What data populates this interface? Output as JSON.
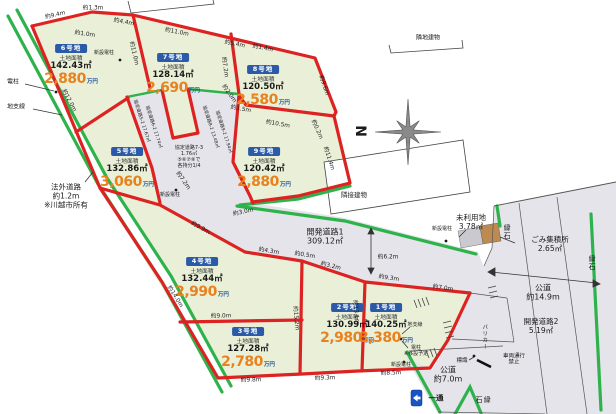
{
  "plots": [
    {
      "id": "6号地",
      "area_label": "土地面積",
      "area": "142.43㎡",
      "price": "2,880",
      "unit": "万円",
      "x": 71,
      "y": 37
    },
    {
      "id": "7号地",
      "area_label": "土地面積",
      "area": "128.14㎡",
      "price": "2,690",
      "unit": "万円",
      "x": 173,
      "y": 46
    },
    {
      "id": "8号地",
      "area_label": "土地面積",
      "area": "120.50㎡",
      "price": "2,580",
      "unit": "万円",
      "x": 263,
      "y": 58
    },
    {
      "id": "5号地",
      "area_label": "土地面積",
      "area": "132.86㎡",
      "price": "3,060",
      "unit": "万円",
      "x": 127,
      "y": 140
    },
    {
      "id": "9号地",
      "area_label": "土地面積",
      "area": "120.42㎡",
      "price": "2,880",
      "unit": "万円",
      "x": 264,
      "y": 140
    },
    {
      "id": "4号地",
      "area_label": "土地面積",
      "area": "132.44㎡",
      "price": "2,990",
      "unit": "万円",
      "x": 202,
      "y": 250
    },
    {
      "id": "3号地",
      "area_label": "土地面積",
      "area": "127.28㎡",
      "price": "2,780",
      "unit": "万円",
      "x": 248,
      "y": 320
    },
    {
      "id": "2号地",
      "area_label": "土地面積",
      "area": "130.99㎡",
      "price": "2,980",
      "unit": "万円",
      "x": 347,
      "y": 296
    },
    {
      "id": "1号地",
      "area_label": "土地面積",
      "area": "140.25㎡",
      "price": "3,380",
      "unit": "万円",
      "x": 386,
      "y": 296
    }
  ],
  "dimensions": [
    {
      "t": "約9.4m",
      "x": 55,
      "y": 14,
      "r": -13
    },
    {
      "t": "約1.3m",
      "x": 93,
      "y": 7,
      "r": 0
    },
    {
      "t": "約1.0m",
      "x": 85,
      "y": 33,
      "r": 8
    },
    {
      "t": "約4.4m",
      "x": 124,
      "y": 21,
      "r": 11
    },
    {
      "t": "約11.0m",
      "x": 177,
      "y": 31,
      "r": 11
    },
    {
      "t": "約5.4m",
      "x": 235,
      "y": 43,
      "r": 11
    },
    {
      "t": "約1.4m",
      "x": 263,
      "y": 47,
      "r": 11
    },
    {
      "t": "約11.0m",
      "x": 135,
      "y": 53,
      "r": 77
    },
    {
      "t": "約12.0m",
      "x": 70,
      "y": 100,
      "r": 62
    },
    {
      "t": "約7.2m",
      "x": 226,
      "y": 67,
      "r": 82
    },
    {
      "t": "約2.0m",
      "x": 230,
      "y": 93,
      "r": 55
    },
    {
      "t": "約1.5m",
      "x": 241,
      "y": 108,
      "r": 10
    },
    {
      "t": "約10.5m",
      "x": 278,
      "y": 123,
      "r": 10
    },
    {
      "t": "約9.6m",
      "x": 325,
      "y": 85,
      "r": 72
    },
    {
      "t": "約0.2m",
      "x": 318,
      "y": 129,
      "r": 66
    },
    {
      "t": "約11.4m",
      "x": 330,
      "y": 158,
      "r": 72
    },
    {
      "t": "約7.2m",
      "x": 184,
      "y": 180,
      "r": 55
    },
    {
      "t": "約3.0m",
      "x": 243,
      "y": 211,
      "r": -12
    },
    {
      "t": "約9.9m",
      "x": 201,
      "y": 227,
      "r": 29
    },
    {
      "t": "約4.3m",
      "x": 269,
      "y": 250,
      "r": 9
    },
    {
      "t": "約0.5m",
      "x": 305,
      "y": 254,
      "r": 9
    },
    {
      "t": "約3.2m",
      "x": 331,
      "y": 265,
      "r": 14
    },
    {
      "t": "約9.3m",
      "x": 389,
      "y": 277,
      "r": 8
    },
    {
      "t": "約7.0m",
      "x": 443,
      "y": 287,
      "r": 8
    },
    {
      "t": "約6.2m",
      "x": 388,
      "y": 256,
      "r": 0
    },
    {
      "t": "約15.2m",
      "x": 297,
      "y": 318,
      "r": 85
    },
    {
      "t": "約13.1m",
      "x": 357,
      "y": 312,
      "r": 85
    },
    {
      "t": "約9.0m",
      "x": 221,
      "y": 315,
      "r": -1
    },
    {
      "t": "約14.0m",
      "x": 176,
      "y": 296,
      "r": 58
    },
    {
      "t": "約9.8m",
      "x": 251,
      "y": 379,
      "r": -2
    },
    {
      "t": "約9.3m",
      "x": 325,
      "y": 377,
      "r": -2
    },
    {
      "t": "約8.5m",
      "x": 391,
      "y": 372,
      "r": -2
    }
  ],
  "notes": [
    {
      "t": "隣地建物",
      "x": 428,
      "y": 38,
      "fs": 6
    },
    {
      "t": "隣接建物",
      "x": 354,
      "y": 196,
      "fs": 6.5
    },
    {
      "t": "開発道路1\n309.12㎡",
      "x": 325,
      "y": 237,
      "fs": 8
    },
    {
      "t": "未利用地\n3.78㎡",
      "x": 471,
      "y": 223,
      "fs": 7.5
    },
    {
      "t": "ごみ集積所\n2.65㎡",
      "x": 550,
      "y": 245,
      "fs": 7.5
    },
    {
      "t": "公道\n約14.9m",
      "x": 543,
      "y": 293,
      "fs": 8
    },
    {
      "t": "開発道路2\n5.19㎡",
      "x": 541,
      "y": 327,
      "fs": 7.5
    },
    {
      "t": "公道\n約7.0m",
      "x": 448,
      "y": 375,
      "fs": 8
    },
    {
      "t": "法外道路\n約1.2m\n※川越市所有",
      "x": 66,
      "y": 197,
      "fs": 7.5
    },
    {
      "t": "縁石",
      "x": 507,
      "y": 232,
      "fs": 7,
      "v": 1
    },
    {
      "t": "縁石",
      "x": 592,
      "y": 263,
      "fs": 7,
      "v": 1
    },
    {
      "t": "縁石",
      "x": 483,
      "y": 400,
      "fs": 7,
      "v": 1
    },
    {
      "t": "バリカー",
      "x": 484,
      "y": 337,
      "fs": 5.5,
      "v": 1
    },
    {
      "t": "標識",
      "x": 462,
      "y": 361,
      "fs": 5.5
    },
    {
      "t": "車両通行\n禁止",
      "x": 514,
      "y": 360,
      "fs": 5.5
    },
    {
      "t": "一通",
      "x": 436,
      "y": 399,
      "fs": 7.5,
      "bold": 1
    },
    {
      "t": "電柱",
      "x": 13,
      "y": 82,
      "fs": 6
    },
    {
      "t": "地支線",
      "x": 16,
      "y": 107,
      "fs": 6
    },
    {
      "t": "新設電柱",
      "x": 104,
      "y": 54,
      "fs": 5
    },
    {
      "t": "新設電柱",
      "x": 170,
      "y": 196,
      "fs": 5
    },
    {
      "t": "新設電柱",
      "x": 442,
      "y": 230,
      "fs": 5
    },
    {
      "t": "新設電柱",
      "x": 401,
      "y": 366,
      "fs": 5
    },
    {
      "t": "地支線",
      "x": 415,
      "y": 326,
      "fs": 5
    },
    {
      "t": "電柱\n※移設予定",
      "x": 416,
      "y": 352,
      "fs": 5
    },
    {
      "t": "N",
      "x": 363,
      "y": 131,
      "fs": 14,
      "r": -90,
      "bold": 1
    },
    {
      "t": "協定道路5-2 17.67㎡",
      "x": 141,
      "y": 121,
      "fs": 4.5,
      "r": 72
    },
    {
      "t": "協定道路6-2 17.74㎡",
      "x": 153,
      "y": 127,
      "fs": 4.5,
      "r": 72
    },
    {
      "t": "協定道路8-2 13.48㎡",
      "x": 210,
      "y": 127,
      "fs": 4.5,
      "r": 72
    },
    {
      "t": "協定道路9-2 17.94㎡",
      "x": 223,
      "y": 132,
      "fs": 4.5,
      "r": 72
    },
    {
      "t": "協定道路7-3\n1.76㎡\n⑤⑥⑦⑧で\n各持分1/4",
      "x": 189,
      "y": 158,
      "fs": 5
    }
  ],
  "colors": {
    "plot_border_red": "#dd2222",
    "curb_green": "#2eb34c",
    "plot_fill": "#eaf0d8",
    "road_fill": "#e4e4ea",
    "badge_blue": "#2a5aa8",
    "price_orange": "#e8821e",
    "unit_blue": "#1a4fa0",
    "oneway_sign_blue": "#1a53c2",
    "dirt_tan": "#bd8a50"
  },
  "icons": {
    "compass": "compass-rose-icon",
    "oneway": "one-way-sign-icon"
  }
}
